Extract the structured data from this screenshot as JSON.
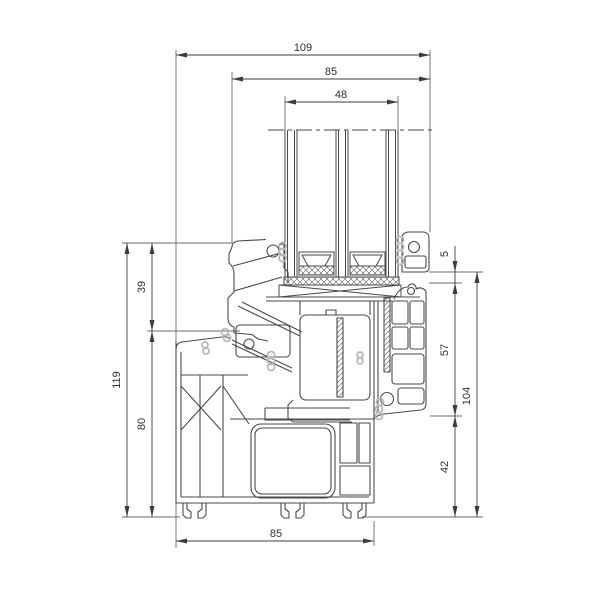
{
  "title": "PVC window frame cross-section drawing",
  "drawing": {
    "units": "mm",
    "dims": {
      "w109": "109",
      "w85_top": "85",
      "w48": "48",
      "h119": "119",
      "h39": "39",
      "h80": "80",
      "h5": "5",
      "h57": "57",
      "h42": "42",
      "h104": "104",
      "w85_bottom": "85"
    },
    "colors": {
      "background": "#ffffff",
      "profile_line": "#4a4a4a",
      "dimension_line": "#3d3d3d",
      "gasket": "#b8b8b8"
    }
  }
}
